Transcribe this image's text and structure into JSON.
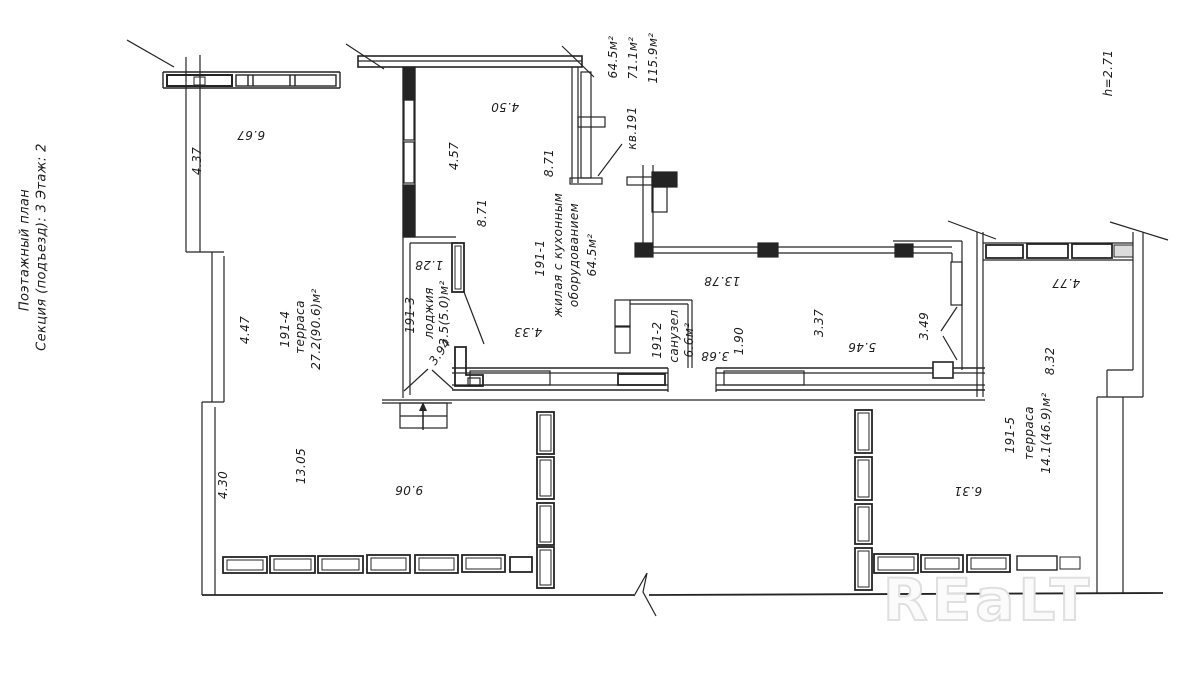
{
  "plan": {
    "title": "Поэтажный план",
    "section": "Секция (подъезд): 3   Этаж: 2",
    "apartment": "кв.191",
    "area_living_total": "64.5м²",
    "area_apartment": "71.1м²",
    "area_with_terraces": "115.9м²",
    "ceiling_height": "h=2.71",
    "watermark": "REaLT"
  },
  "rooms": {
    "living": {
      "id": "191-1",
      "name_line1": "жилая с кухонным",
      "name_line2": "оборудованием",
      "area": "64.5м²"
    },
    "bathroom": {
      "id": "191-2",
      "name": "санузел",
      "area": "6.6м²"
    },
    "loggia": {
      "id": "191-3",
      "name": "лоджия",
      "area": "3.5(5.0)м²"
    },
    "terrace_left": {
      "id": "191-4",
      "name": "терраса",
      "area": "27.2(90.6)м²"
    },
    "terrace_right": {
      "id": "191-5",
      "name": "терраса",
      "area": "14.1(46.9)м²"
    }
  },
  "dimensions": {
    "top_left_width": "4.37",
    "top_left_length": "6.67",
    "living_top_width": "4.50",
    "living_west_upper": "4.57",
    "living_west_lower": "8.71",
    "living_mid_height": "8.71",
    "terrace_left_width": "4.47",
    "loggia_sill": "1.28",
    "loggia_width": "3.94",
    "living_south_west": "4.33",
    "hall_length": "13.78",
    "bath_length": "3.68",
    "bath_width": "1.90",
    "living_east_upper": "3.37",
    "living_south_east": "5.46",
    "living_east_door": "3.49",
    "terrace_right_top": "4.77",
    "terrace_right_east": "8.32",
    "terrace_right_south": "6.31",
    "terrace_left_lower_width": "4.30",
    "terrace_left_length": "13.05",
    "terrace_left_south": "9.06"
  }
}
